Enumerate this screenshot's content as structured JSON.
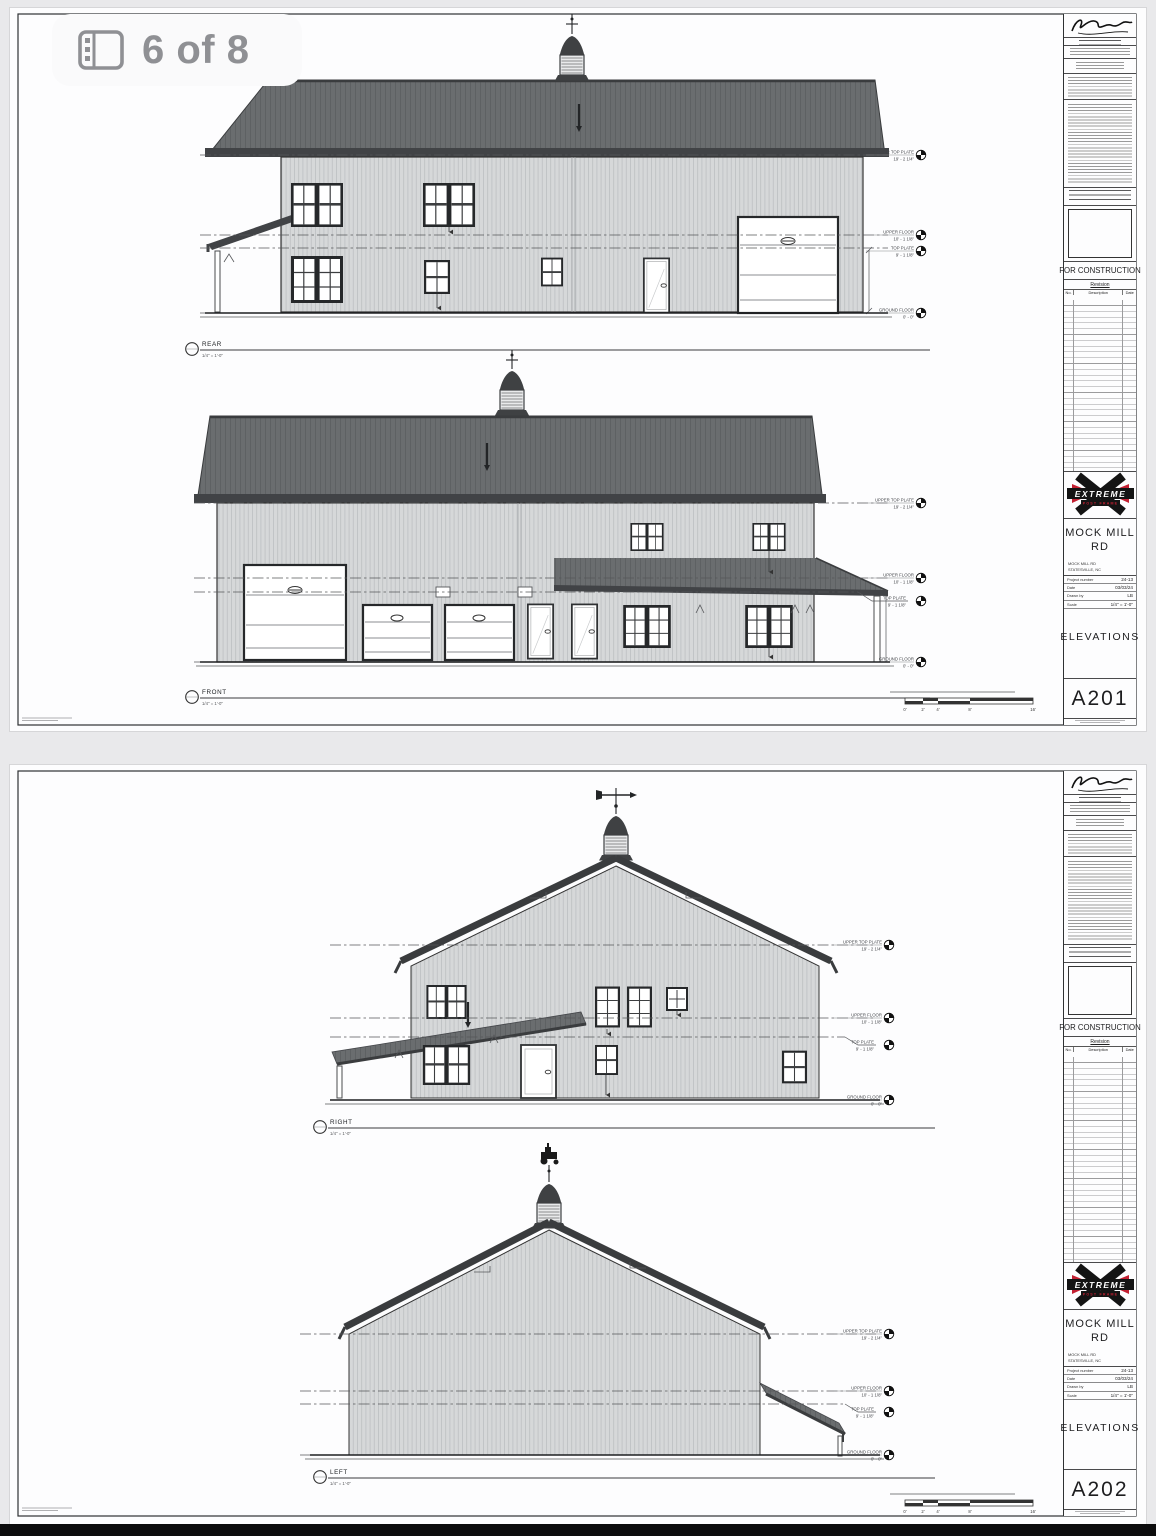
{
  "viewer": {
    "badge_label": "6 of 8"
  },
  "levels": [
    {
      "name": "UPPER TOP PLATE",
      "elevation": "19' - 2 1/4\""
    },
    {
      "name": "UPPER FLOOR",
      "elevation": "10' - 1 1/8\""
    },
    {
      "name": "TOP PLATE",
      "elevation": "9' - 1 1/8\""
    },
    {
      "name": "GROUND FLOOR",
      "elevation": "0' - 0\""
    }
  ],
  "scalebar": {
    "ticks": [
      "0'",
      "2'",
      "4'",
      "8'",
      "16'"
    ]
  },
  "titleblock": {
    "stamp_note": "FOR CONSTRUCTION",
    "revision": {
      "title": "Revision",
      "col_no": "No.",
      "col_desc": "Description",
      "col_date": "Date"
    },
    "logo": {
      "brand": "EXTREME",
      "sub": "POST FRAME"
    },
    "project_name_line1": "MOCK MILL",
    "project_name_line2": "RD",
    "address_line1": "MOCK MILL RD",
    "address_line2": "STATESVILLE, NC",
    "fields": [
      {
        "label": "Project number",
        "value": "24-13"
      },
      {
        "label": "Date",
        "value": "03/03/24"
      },
      {
        "label": "Drawn by",
        "value": "LB"
      },
      {
        "label": "Scale",
        "value": "1/4\" = 1'-0\""
      }
    ],
    "sheet_title": "ELEVATIONS"
  },
  "sheets": [
    {
      "number": "A201",
      "views": [
        {
          "name": "REAR",
          "scale": "1/4\" = 1'-0\""
        },
        {
          "name": "FRONT",
          "scale": "1/4\" = 1'-0\""
        }
      ]
    },
    {
      "number": "A202",
      "views": [
        {
          "name": "RIGHT",
          "scale": "1/4\" = 1'-0\""
        },
        {
          "name": "LEFT",
          "scale": "1/4\" = 1'-0\""
        }
      ]
    }
  ]
}
